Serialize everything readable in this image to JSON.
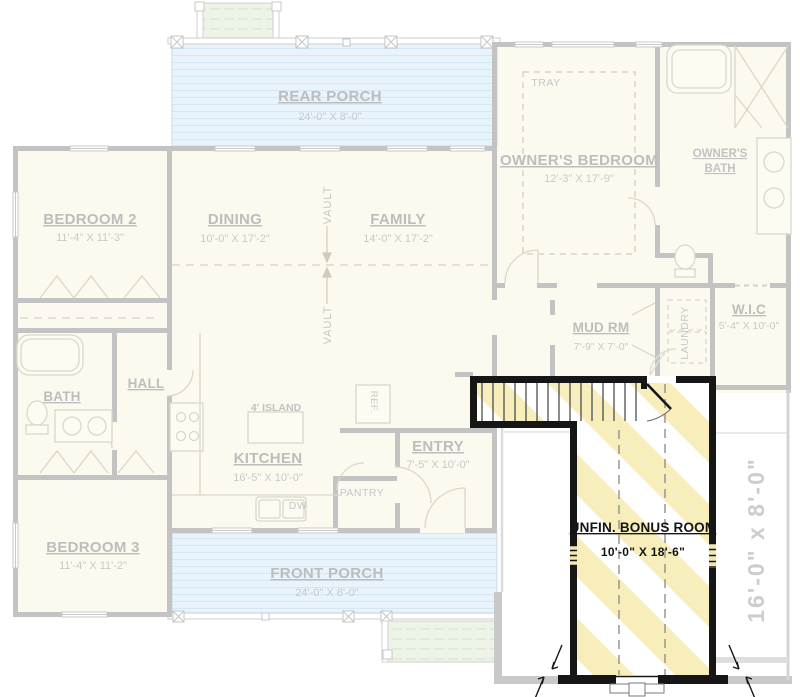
{
  "colors": {
    "highlight_stripe": "#f7eebb",
    "highlight_wall": "#161616",
    "porch_blue": "#e8f3fb",
    "steps_green": "#edf3e7",
    "faded_wall": "#c3c3c3",
    "faded_text": "#bdbdbd",
    "background": "#ffffff"
  },
  "rooms": {
    "rear_porch": {
      "name": "REAR PORCH",
      "dims": "24'-0\" X 8'-0\""
    },
    "tray": {
      "name": "TRAY"
    },
    "owners_bedroom": {
      "name": "OWNER'S BEDROOM",
      "dims": "12'-3\" X 17'-9\""
    },
    "owners_bath": {
      "line1": "OWNER'S",
      "line2": "BATH"
    },
    "bedroom2": {
      "name": "BEDROOM 2",
      "dims": "11'-4\" X 11'-3\""
    },
    "dining": {
      "name": "DINING",
      "dims": "10'-0\" X 17'-2\""
    },
    "family": {
      "name": "FAMILY",
      "dims": "14'-0\" X 17'-2\""
    },
    "vault": {
      "name": "VAULT"
    },
    "mud_rm": {
      "name": "MUD RM",
      "dims": "7'-9\" X 7'-0\""
    },
    "laundry": {
      "name": "LAUNDRY"
    },
    "wic": {
      "name": "W.I.C",
      "dims": "5'-4\" X 10'-0\""
    },
    "bath": {
      "name": "BATH"
    },
    "hall": {
      "name": "HALL"
    },
    "island": {
      "name": "4' ISLAND"
    },
    "kitchen": {
      "name": "KITCHEN",
      "dims": "16'-5\" X 10'-0\""
    },
    "ref": {
      "name": "REF."
    },
    "entry": {
      "name": "ENTRY",
      "dims": "7'-5\" X 10'-0\""
    },
    "pantry": {
      "name": "PANTRY"
    },
    "dw": {
      "name": "DW"
    },
    "bedroom3": {
      "name": "BEDROOM 3",
      "dims": "11'-4\" X 11'-2\""
    },
    "front_porch": {
      "name": "FRONT PORCH",
      "dims": "24'-0\" X 8'-0\""
    },
    "bonus": {
      "name": "UNFIN. BONUS ROOM",
      "dims": "10'-0\" X 18'-6\""
    },
    "side_deck": {
      "dims": "16'-0\" x 8'-0\""
    }
  }
}
